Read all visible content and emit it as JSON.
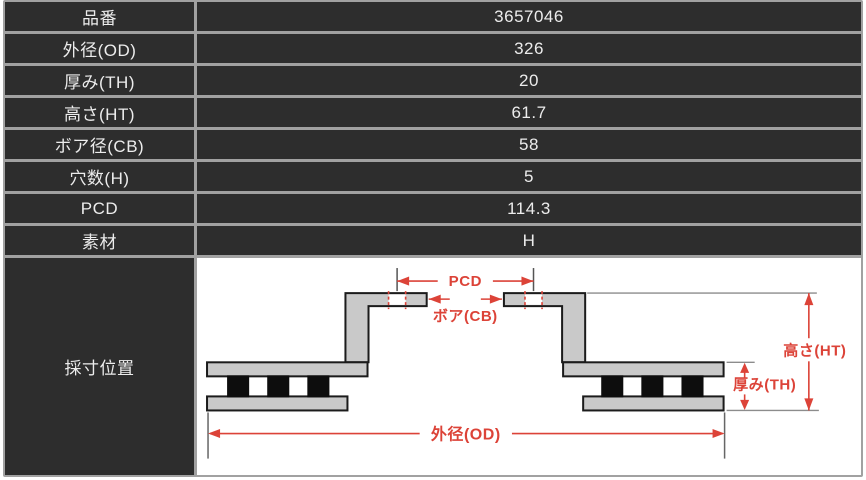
{
  "table": {
    "rows": [
      {
        "label": "品番",
        "value": "3657046"
      },
      {
        "label": "外径(OD)",
        "value": "326"
      },
      {
        "label": "厚み(TH)",
        "value": "20"
      },
      {
        "label": "高さ(HT)",
        "value": "61.7"
      },
      {
        "label": "ボア径(CB)",
        "value": "58"
      },
      {
        "label": "穴数(H)",
        "value": "5"
      },
      {
        "label": "PCD",
        "value": "114.3"
      },
      {
        "label": "素材",
        "value": "H"
      }
    ],
    "diagram_label": "採寸位置"
  },
  "diagram": {
    "labels": {
      "pcd": "PCD",
      "bore": "ボア(CB)",
      "height": "高さ(HT)",
      "thickness": "厚み(TH)",
      "outer_diameter": "外径(OD)"
    }
  },
  "colors": {
    "cell_background": "#2d2d2d",
    "table_border": "#a1a1a1",
    "cell_text": "#ececec",
    "dimension_red": "#dc4338",
    "rotor_fill": "#c9c9c9",
    "rotor_outline": "#1b1b1b",
    "vent_black": "#0d0d0d",
    "extension_gray": "#8c8c8c"
  }
}
